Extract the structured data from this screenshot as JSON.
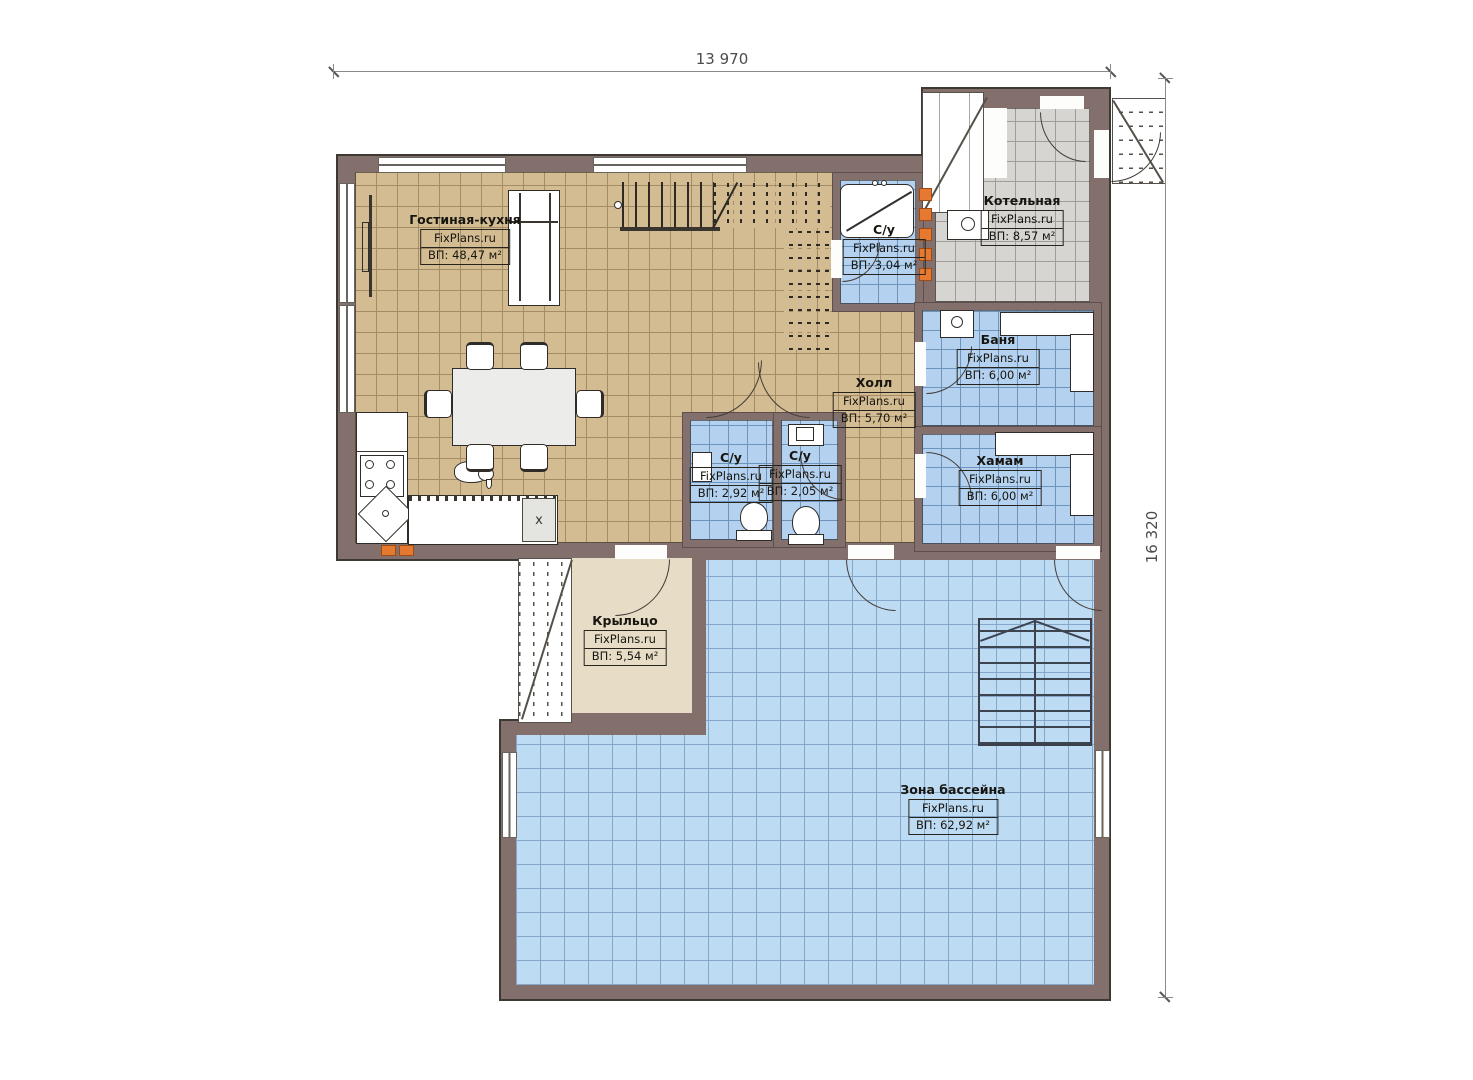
{
  "dimensions": {
    "width": "13 970",
    "height": "16 320"
  },
  "rooms": [
    {
      "id": "living-kitchen",
      "name": "Гостиная-кухня",
      "brand": "FixPlans.ru",
      "area": "ВП: 48,47 м²"
    },
    {
      "id": "boiler",
      "name": "Котельная",
      "brand": "FixPlans.ru",
      "area": "ВП: 8,57 м²"
    },
    {
      "id": "wc-top",
      "name": "С/у",
      "brand": "FixPlans.ru",
      "area": "ВП: 3,04 м²"
    },
    {
      "id": "banya",
      "name": "Баня",
      "brand": "FixPlans.ru",
      "area": "ВП: 6,00 м²"
    },
    {
      "id": "hall",
      "name": "Холл",
      "brand": "FixPlans.ru",
      "area": "ВП: 5,70 м²"
    },
    {
      "id": "hamam",
      "name": "Хамам",
      "brand": "FixPlans.ru",
      "area": "ВП: 6,00 м²"
    },
    {
      "id": "wc-left",
      "name": "С/у",
      "brand": "FixPlans.ru",
      "area": "ВП: 2,92 м²"
    },
    {
      "id": "wc-right",
      "name": "С/у",
      "brand": "FixPlans.ru",
      "area": "ВП: 2,05 м²"
    },
    {
      "id": "porch",
      "name": "Крыльцо",
      "brand": "FixPlans.ru",
      "area": "ВП: 5,54 м²"
    },
    {
      "id": "pool-zone",
      "name": "Зона бассейна",
      "brand": "FixPlans.ru",
      "area": "ВП: 62,92 м²"
    }
  ],
  "kitchen": {
    "island_mark": "x"
  },
  "colors": {
    "wall": "#83706d",
    "tan": "#d3bc92",
    "tanline": "#a48d66",
    "blue": "#b4d2ef",
    "blueline": "#6f94bb",
    "pool": "#bedbf4",
    "poolline": "#84a7c9",
    "gray": "#d6d5d2",
    "grayline": "#9e9d9a",
    "porch": "#e7ddc7",
    "accent": "#e5792f"
  }
}
